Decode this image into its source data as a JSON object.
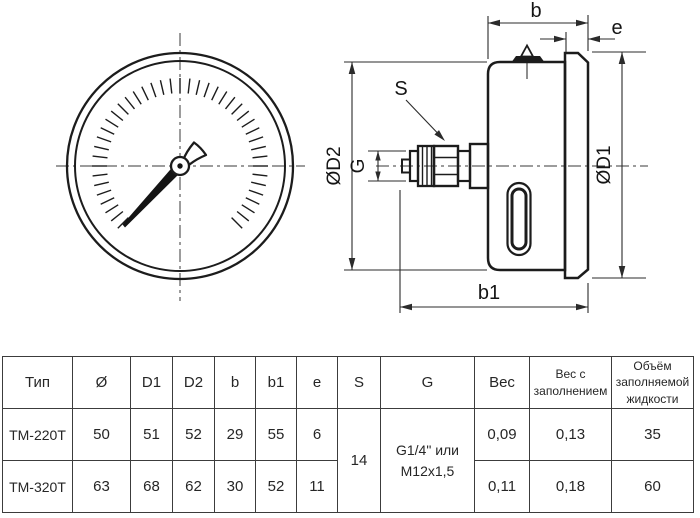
{
  "drawing": {
    "labels": {
      "b": "b",
      "e": "e",
      "s": "S",
      "g": "G",
      "d1": "ØD1",
      "d2": "ØD2",
      "b1": "b1"
    }
  },
  "table": {
    "headers": [
      "Тип",
      "Ø",
      "D1",
      "D2",
      "b",
      "b1",
      "e",
      "S",
      "G",
      "Вес",
      "Вес с заполнением",
      "Объём заполняемой жидкости"
    ],
    "rows": [
      [
        "ТМ-220Т",
        "50",
        "51",
        "52",
        "29",
        "55",
        "6",
        "0,09",
        "0,13",
        "35"
      ],
      [
        "ТМ-320Т",
        "63",
        "68",
        "62",
        "30",
        "52",
        "11",
        "0,11",
        "0,18",
        "60"
      ]
    ],
    "merged": {
      "s": "14",
      "g_line1": "G1/4\" или",
      "g_line2": "M12x1,5"
    }
  }
}
